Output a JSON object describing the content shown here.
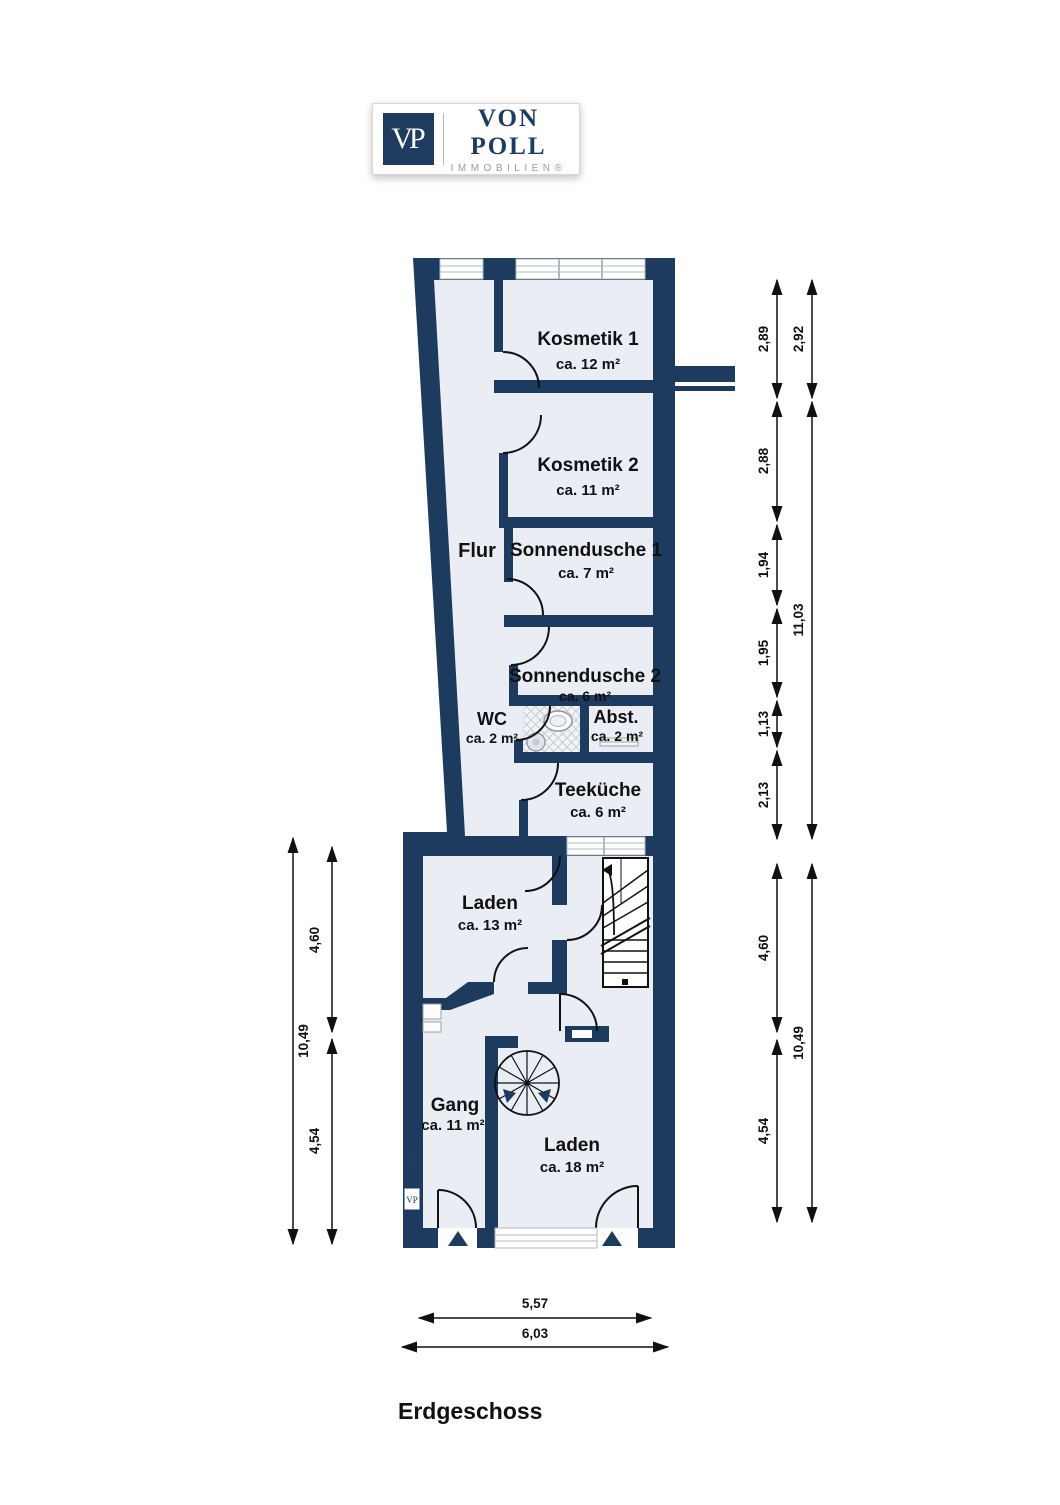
{
  "logo": {
    "vp": "VP",
    "brand": "VON POLL",
    "sub": "IMMOBILIEN®"
  },
  "title": "Erdgeschoss",
  "colors": {
    "wall": "#1c3b5f",
    "room_fill": "#ebedf4",
    "line": "#111111",
    "window_frame": "#b3b8bf",
    "logo_navy": "#1d3c5f",
    "logo_gray": "#9b9b9b"
  },
  "rooms": [
    {
      "name": "Kosmetik 1",
      "area": "ca. 12 m²"
    },
    {
      "name": "Kosmetik 2",
      "area": "ca. 11 m²"
    },
    {
      "name": "Flur",
      "area": ""
    },
    {
      "name": "Sonnendusche 1",
      "area": "ca. 7 m²"
    },
    {
      "name": "Sonnendusche 2",
      "area": "ca. 6 m²"
    },
    {
      "name": "WC",
      "area": "ca. 2 m²"
    },
    {
      "name": "Abst.",
      "area": "ca. 2 m²"
    },
    {
      "name": "Teeküche",
      "area": "ca. 6 m²"
    },
    {
      "name": "Laden",
      "area": "ca. 13 m²"
    },
    {
      "name": "Gang",
      "area": "ca. 11 m²"
    },
    {
      "name": "Laden",
      "area": "ca. 18 m²"
    }
  ],
  "dimensions": {
    "right_upper_inner": [
      "2,89",
      "2,88",
      "1,94",
      "1,95",
      "1,13",
      "2,13"
    ],
    "right_upper_outer": [
      "2,92",
      "11,03"
    ],
    "right_lower_inner": [
      "4,60",
      "4,54"
    ],
    "right_lower_outer": [
      "10,49"
    ],
    "left_outer": [
      "10,49"
    ],
    "left_inner": [
      "4,60",
      "4,54"
    ],
    "bottom": [
      "5,57",
      "6,03"
    ]
  },
  "watermark": {
    "brand": "VON POLL",
    "sub": "IMMOBILIEN",
    "vp": "VP"
  }
}
